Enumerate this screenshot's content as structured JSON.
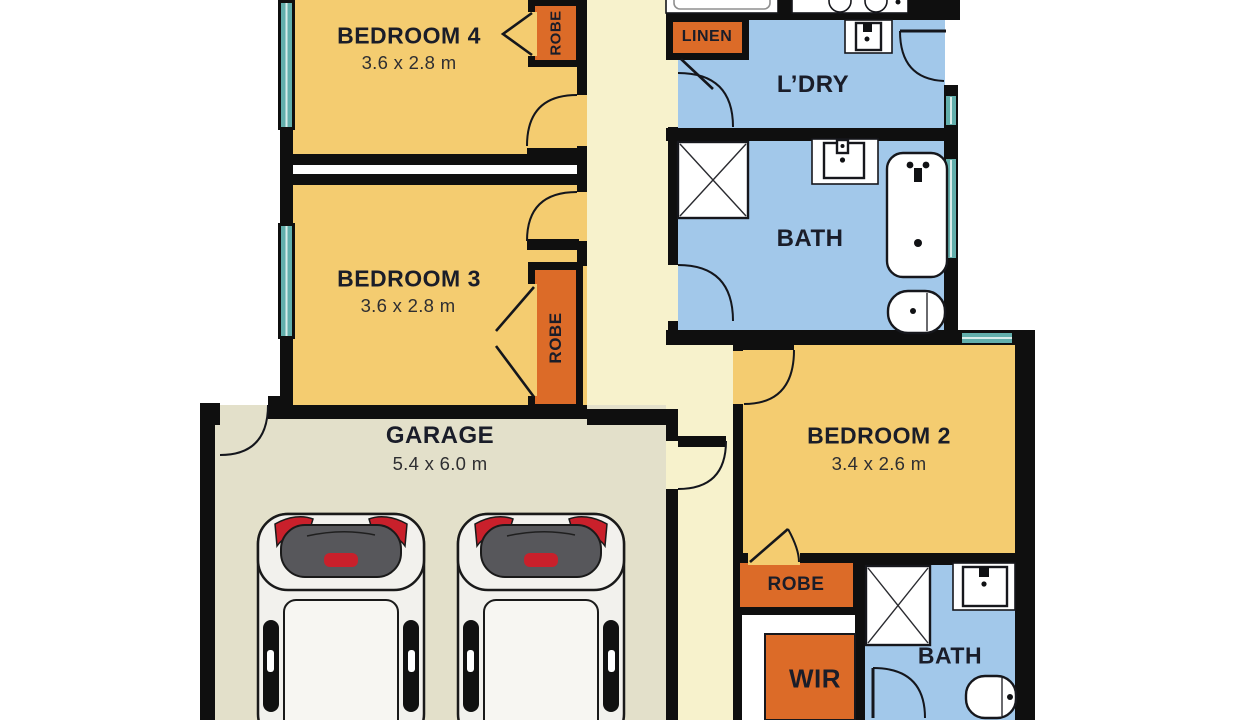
{
  "rooms": {
    "bedroom4": {
      "name": "BEDROOM 4",
      "dims": "3.6 x 2.8 m"
    },
    "bedroom3": {
      "name": "BEDROOM 3",
      "dims": "3.6 x 2.8 m"
    },
    "bedroom2": {
      "name": "BEDROOM 2",
      "dims": "3.4 x 2.6 m"
    },
    "garage": {
      "name": "GARAGE",
      "dims": "5.4 x 6.0 m"
    },
    "laundry": {
      "name": "L’DRY"
    },
    "bath": {
      "name": "BATH"
    },
    "ensuite": {
      "name": "BATH"
    },
    "linen": {
      "name": "LINEN"
    },
    "robe4": {
      "name": "ROBE"
    },
    "robe3": {
      "name": "ROBE"
    },
    "robe2": {
      "name": "ROBE"
    },
    "wir": {
      "name": "WIR"
    }
  },
  "fixtures": [
    "shower-icon",
    "vanity-icon",
    "bathtub-icon",
    "toilet-icon",
    "laundry-trough-icon",
    "kitchen-sink-icon",
    "cooktop-icon",
    "car-icon",
    "window-icon",
    "door-arc-icon",
    "bifold-door-icon"
  ],
  "colors": {
    "wall": "#0f0f0f",
    "bedroom": "#F4CC70",
    "robe": "#DC6B28",
    "wet": "#A2C8EA",
    "hall": "#F7F2CC",
    "garage": "#E3E0CA",
    "window": "#62AFAC",
    "label": "#1A1D29",
    "car_red": "#C9202B",
    "car_window": "#57575B"
  }
}
